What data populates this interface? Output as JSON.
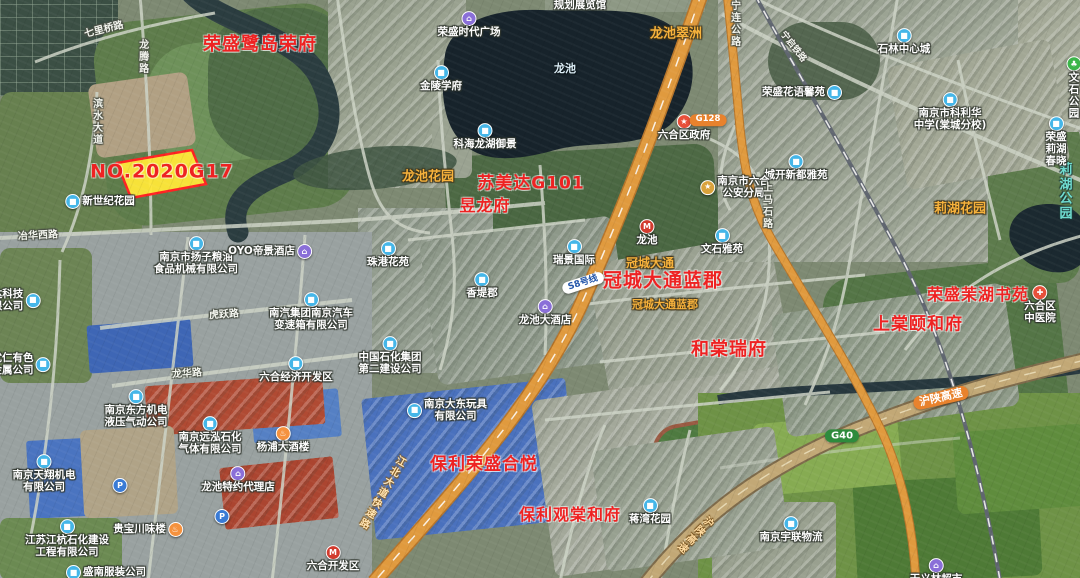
{
  "map": {
    "canvas_width": 1080,
    "canvas_height": 578,
    "colors": {
      "estate_annotation": "#ee2222",
      "parcel_fill": "#ffe838",
      "parcel_border": "#ff2222",
      "area_label": "#f7b23c",
      "park_label": "#6fdcd0",
      "major_road": "#e09a3e",
      "expressway": "#c2a876",
      "water": "#17232b"
    },
    "icons": {
      "building": {
        "glyph": "■",
        "bg": "#45b6e8"
      },
      "shop": {
        "glyph": "⌂",
        "bg": "#8a6fd8"
      },
      "hotel": {
        "glyph": "⌂",
        "bg": "#8a6fd8"
      },
      "restaurant": {
        "glyph": "♨",
        "bg": "#f5923e"
      },
      "gov": {
        "glyph": "★",
        "bg": "#e8503a"
      },
      "police": {
        "glyph": "★",
        "bg": "#d9a23c"
      },
      "hospital": {
        "glyph": "✚",
        "bg": "#e8503a"
      },
      "park": {
        "glyph": "♣",
        "bg": "#3cb54a"
      },
      "metro": {
        "glyph": "M",
        "bg": "#d23b2e"
      },
      "parking": {
        "glyph": "P",
        "bg": "#3a7bd5"
      }
    },
    "labels": [
      {
        "name": "estate-rongsheng-ludao-rongfu",
        "type": "estate",
        "text": "荣盛鹭岛荣府",
        "x": 260,
        "y": 45,
        "fs": 18
      },
      {
        "name": "estate-parcel-no2020g17",
        "type": "estate",
        "text": "NO.2020G17",
        "x": 162,
        "y": 172,
        "fs": 19
      },
      {
        "name": "estate-sumeida-g101",
        "type": "estate",
        "text": "苏美达G101",
        "x": 531,
        "y": 184,
        "fs": 17
      },
      {
        "name": "estate-yulongfu",
        "type": "estate",
        "text": "昱龙府",
        "x": 485,
        "y": 206,
        "fs": 16
      },
      {
        "name": "estate-guancheng-datong-lanjun",
        "type": "estate",
        "text": "冠城大通蓝郡",
        "x": 663,
        "y": 281,
        "fs": 19
      },
      {
        "name": "estate-hetang-ruifu",
        "type": "estate",
        "text": "和棠瑞府",
        "x": 729,
        "y": 350,
        "fs": 18
      },
      {
        "name": "estate-rongsheng-mohu-shuyuan",
        "type": "estate",
        "text": "荣盛茉湖书苑",
        "x": 978,
        "y": 295,
        "fs": 16
      },
      {
        "name": "estate-shangtang-yihefu",
        "type": "estate",
        "text": "上棠颐和府",
        "x": 918,
        "y": 325,
        "fs": 17
      },
      {
        "name": "estate-baoli-rongsheng-heyue",
        "type": "estate",
        "text": "保利荣盛合悦",
        "x": 484,
        "y": 465,
        "fs": 17
      },
      {
        "name": "estate-baoli-guantang-hefu",
        "type": "estate",
        "text": "保利观棠和府",
        "x": 570,
        "y": 515,
        "fs": 16
      },
      {
        "name": "area-longchi-cuizhou",
        "type": "area",
        "text": "龙池翠洲",
        "x": 676,
        "y": 35,
        "fs": 13,
        "inter": true
      },
      {
        "name": "area-longchi-huayuan",
        "type": "area",
        "text": "龙池花园",
        "x": 428,
        "y": 178,
        "fs": 13,
        "inter": true
      },
      {
        "name": "area-lihu-huayuan",
        "type": "area",
        "text": "莉湖花园",
        "x": 960,
        "y": 210,
        "fs": 13,
        "inter": true
      },
      {
        "name": "area-guancheng-datong",
        "type": "area",
        "text": "冠城大通",
        "x": 650,
        "y": 264,
        "fs": 12,
        "inter": true
      },
      {
        "name": "area-guancheng-datong-lanjun-small",
        "type": "area-sm",
        "text": "冠城大通蓝郡",
        "x": 665,
        "y": 305,
        "fs": 11,
        "inter": true
      },
      {
        "name": "park-lihu-gongyuan",
        "type": "park",
        "text": "莉湖公园",
        "x": 1066,
        "y": 193,
        "fs": 13,
        "inter": true
      },
      {
        "name": "water-longchi-lake",
        "type": "water",
        "text": "龙池",
        "x": 565,
        "y": 69,
        "fs": 11
      },
      {
        "name": "poi-guihua-zhanlanguan",
        "type": "poi",
        "text": "规划展览馆",
        "x": 580,
        "y": 6,
        "inter": true
      },
      {
        "name": "poi-rongsheng-shidai-guangchang",
        "type": "poi",
        "text": "荣盛时代广场",
        "x": 469,
        "y": 25,
        "icon": "shop",
        "inter": true
      },
      {
        "name": "poi-jinling-xuefu",
        "type": "poi",
        "text": "金陵学府",
        "x": 441,
        "y": 79,
        "icon": "building",
        "inter": true
      },
      {
        "name": "poi-kehai-longhu-yujing",
        "type": "poi",
        "text": "科海龙湖御景",
        "x": 485,
        "y": 137,
        "icon": "building",
        "inter": true
      },
      {
        "name": "poi-shilin-zhongxincheng",
        "type": "poi",
        "text": "石林中心城",
        "x": 904,
        "y": 42,
        "icon": "building",
        "inter": true
      },
      {
        "name": "poi-rongsheng-huayu-xinyuan",
        "type": "poi",
        "text": "荣盛花语馨苑",
        "x": 802,
        "y": 93,
        "icon": "building",
        "ipos": "right",
        "inter": true
      },
      {
        "name": "poi-kelihua-middle-school",
        "type": "poi",
        "text": "南京市科利华\n中学(棠城分校)",
        "x": 950,
        "y": 112,
        "icon": "building",
        "inter": true
      },
      {
        "name": "poi-wenshi-gongyuan",
        "type": "poi",
        "text": "文石公园",
        "x": 1074,
        "y": 88,
        "icon": "park",
        "inter": true
      },
      {
        "name": "poi-rongsheng-lihu-chunxiao",
        "type": "poi",
        "text": "荣盛莉湖春晓",
        "x": 1056,
        "y": 142,
        "icon": "building",
        "inter": true
      },
      {
        "name": "poi-chengkai-xindu-yayuan",
        "type": "poi",
        "text": "城开新都雅苑",
        "x": 796,
        "y": 168,
        "icon": "building",
        "inter": true
      },
      {
        "name": "poi-luhe-district-government",
        "type": "poi",
        "text": "六合区政府",
        "x": 684,
        "y": 128,
        "icon": "gov",
        "inter": true
      },
      {
        "name": "metro-longchi-station",
        "type": "metro",
        "text": "龙池",
        "x": 647,
        "y": 233,
        "icon": "metro",
        "inter": true
      },
      {
        "name": "poi-xinshiji-huayuan",
        "type": "poi",
        "text": "新世纪花园",
        "x": 100,
        "y": 202,
        "icon": "building",
        "ipos": "left",
        "inter": true
      },
      {
        "name": "poi-yangzi-liangyou",
        "type": "poi",
        "text": "南京市扬子粮油\n食品机械有限公司",
        "x": 196,
        "y": 256,
        "icon": "building",
        "inter": true
      },
      {
        "name": "poi-oyo-dijing-hotel",
        "type": "poi",
        "text": "OYO帝景酒店",
        "x": 270,
        "y": 252,
        "icon": "hotel",
        "ipos": "right",
        "inter": true
      },
      {
        "name": "poi-xunda-keji-clipped",
        "type": "poi",
        "text": "达科技\n限公司",
        "x": 16,
        "y": 301,
        "icon": "building",
        "ipos": "right",
        "inter": true
      },
      {
        "name": "poi-youren-youse-jinshu",
        "type": "poi",
        "text": "优仁有色\n金属公司",
        "x": 21,
        "y": 365,
        "icon": "building",
        "ipos": "right",
        "inter": true
      },
      {
        "name": "poi-nanqi-bianshuxiang",
        "type": "poi",
        "text": "南汽集团南京汽车\n变速箱有限公司",
        "x": 311,
        "y": 312,
        "icon": "building",
        "inter": true
      },
      {
        "name": "poi-luhe-jingji-kaifaqu",
        "type": "poi",
        "text": "六合经济开发区",
        "x": 296,
        "y": 370,
        "icon": "building",
        "inter": true
      },
      {
        "name": "poi-zhongguo-shihua-dier",
        "type": "poi",
        "text": "中国石化集团\n第二建设公司",
        "x": 390,
        "y": 356,
        "icon": "building",
        "inter": true
      },
      {
        "name": "poi-zhugang-huayuan",
        "type": "poi",
        "text": "珠港花苑",
        "x": 388,
        "y": 255,
        "icon": "building",
        "inter": true
      },
      {
        "name": "poi-ruijing-guoji",
        "type": "poi",
        "text": "瑞景国际",
        "x": 574,
        "y": 253,
        "icon": "building",
        "inter": true
      },
      {
        "name": "poi-xiangdijun",
        "type": "poi",
        "text": "香堤郡",
        "x": 482,
        "y": 286,
        "icon": "building",
        "inter": true
      },
      {
        "name": "poi-longchi-dajiudian",
        "type": "poi",
        "text": "龙池大酒店",
        "x": 545,
        "y": 313,
        "icon": "hotel",
        "inter": true
      },
      {
        "name": "poi-wenshi-yayuan",
        "type": "poi",
        "text": "文石雅苑",
        "x": 722,
        "y": 242,
        "icon": "building",
        "inter": true
      },
      {
        "name": "poi-luhe-gongan-fenju",
        "type": "poi",
        "text": "南京市六合\n公安分局",
        "x": 735,
        "y": 188,
        "icon": "police",
        "ipos": "left",
        "inter": true
      },
      {
        "name": "poi-luhe-zhongyiyuan",
        "type": "poi",
        "text": "六合区\n中医院",
        "x": 1040,
        "y": 305,
        "icon": "hospital",
        "inter": true
      },
      {
        "name": "poi-jiangwan-huayuan",
        "type": "poi",
        "text": "蒋湾花园",
        "x": 650,
        "y": 512,
        "icon": "building",
        "inter": true
      },
      {
        "name": "poi-dadong-wanju",
        "type": "poi",
        "text": "南京大东玩具\n有限公司",
        "x": 447,
        "y": 411,
        "icon": "building",
        "ipos": "left",
        "inter": true
      },
      {
        "name": "poi-dongfang-jidian",
        "type": "poi",
        "text": "南京东方机电\n液压气动公司",
        "x": 136,
        "y": 409,
        "icon": "building",
        "inter": true
      },
      {
        "name": "poi-yuanhong-shihua",
        "type": "poi",
        "text": "南京远泓石化\n气体有限公司",
        "x": 210,
        "y": 436,
        "icon": "building",
        "inter": true
      },
      {
        "name": "poi-yangpu-dajiulou",
        "type": "poi",
        "text": "杨浦大酒楼",
        "x": 283,
        "y": 440,
        "icon": "restaurant",
        "inter": true
      },
      {
        "name": "poi-tianxiang-jidian",
        "type": "poi",
        "text": "南京天翔机电\n有限公司",
        "x": 44,
        "y": 474,
        "icon": "building",
        "inter": true
      },
      {
        "name": "poi-longchi-teyue-dailidian",
        "type": "poi",
        "text": "龙池特约代理店",
        "x": 238,
        "y": 480,
        "icon": "shop",
        "inter": true
      },
      {
        "name": "poi-guibao-chuanweilou",
        "type": "poi",
        "text": "贵宝川味楼",
        "x": 148,
        "y": 530,
        "icon": "restaurant",
        "ipos": "right",
        "inter": true
      },
      {
        "name": "poi-jianghang-shihua",
        "type": "poi",
        "text": "江苏江杭石化建设\n工程有限公司",
        "x": 67,
        "y": 539,
        "icon": "building",
        "inter": true
      },
      {
        "name": "poi-shengnan-fuzhuang",
        "type": "poi",
        "text": "盛南服装公司",
        "x": 106,
        "y": 573,
        "icon": "building",
        "ipos": "left",
        "inter": true
      },
      {
        "name": "poi-yulian-wuliu",
        "type": "poi",
        "text": "南京宇联物流",
        "x": 791,
        "y": 530,
        "icon": "building",
        "inter": true
      },
      {
        "name": "poi-tianyilin-chaoshi",
        "type": "poi",
        "text": "天义林超市",
        "x": 936,
        "y": 572,
        "icon": "shop",
        "inter": true
      },
      {
        "name": "metro-luhe-kaifaqu-station",
        "type": "metro",
        "text": "六合开发区",
        "x": 333,
        "y": 559,
        "icon": "metro",
        "inter": true
      },
      {
        "name": "poi-parking-1",
        "type": "poi",
        "text": "",
        "x": 120,
        "y": 486,
        "icon": "parking",
        "inter": true
      },
      {
        "name": "poi-parking-2",
        "type": "poi",
        "text": "",
        "x": 222,
        "y": 517,
        "icon": "parking",
        "inter": true
      },
      {
        "name": "road-ninglian-gonglu",
        "type": "road",
        "text": "宁连公路",
        "x": 734,
        "y": 24,
        "vert": true
      },
      {
        "name": "road-qiliqiao-lu",
        "type": "road",
        "text": "七里桥路",
        "x": 104,
        "y": 30,
        "rot": -14
      },
      {
        "name": "road-longteng-lu",
        "type": "road",
        "text": "龙腾路",
        "x": 142,
        "y": 57,
        "vert": true
      },
      {
        "name": "road-binshui-dadao",
        "type": "road",
        "text": "滨水大道",
        "x": 96,
        "y": 122,
        "vert": true
      },
      {
        "name": "road-yehua-xilu",
        "type": "road",
        "text": "冶华西路",
        "x": 38,
        "y": 236,
        "rot": -3
      },
      {
        "name": "road-huyue-lu",
        "type": "road",
        "text": "虎跃路",
        "x": 224,
        "y": 315,
        "rot": -4
      },
      {
        "name": "road-longhua-lu",
        "type": "road",
        "text": "龙华路",
        "x": 187,
        "y": 374,
        "rot": -4
      },
      {
        "name": "road-shangmashi-lu",
        "type": "road",
        "text": "上马石路",
        "x": 766,
        "y": 206,
        "vert": true
      },
      {
        "name": "road-ningqi-railway",
        "type": "road",
        "text": "宁启铁路",
        "x": 793,
        "y": 47,
        "rot": 52,
        "fs": 9
      },
      {
        "name": "road-jiangbei-dadao",
        "type": "road-hl",
        "text": "江北大道快速路",
        "x": 381,
        "y": 492,
        "vert": true,
        "rot": 30
      },
      {
        "name": "road-hushan-expwy-west",
        "type": "hwy-label",
        "text": "沪陕高速",
        "x": 694,
        "y": 534,
        "vert": true,
        "rot": 45,
        "fs": 10
      },
      {
        "name": "badge-hushan-expressway",
        "type": "badge",
        "text": "沪陕高速",
        "x": 941,
        "y": 398,
        "rot": -13,
        "bg": "#e8822d",
        "fs": 11
      },
      {
        "name": "badge-g40",
        "type": "badge",
        "text": "G40",
        "x": 842,
        "y": 436,
        "bg": "#2e8b3d",
        "fs": 10
      },
      {
        "name": "badge-g128",
        "type": "badge",
        "text": "G128",
        "x": 708,
        "y": 120,
        "bg": "#e8822d",
        "fs": 8.5
      },
      {
        "name": "badge-s8-line",
        "type": "badge",
        "text": "S8号线",
        "x": 583,
        "y": 283,
        "rot": -18,
        "bg": "#ffffff",
        "fg": "#2255aa",
        "fs": 9
      }
    ]
  }
}
